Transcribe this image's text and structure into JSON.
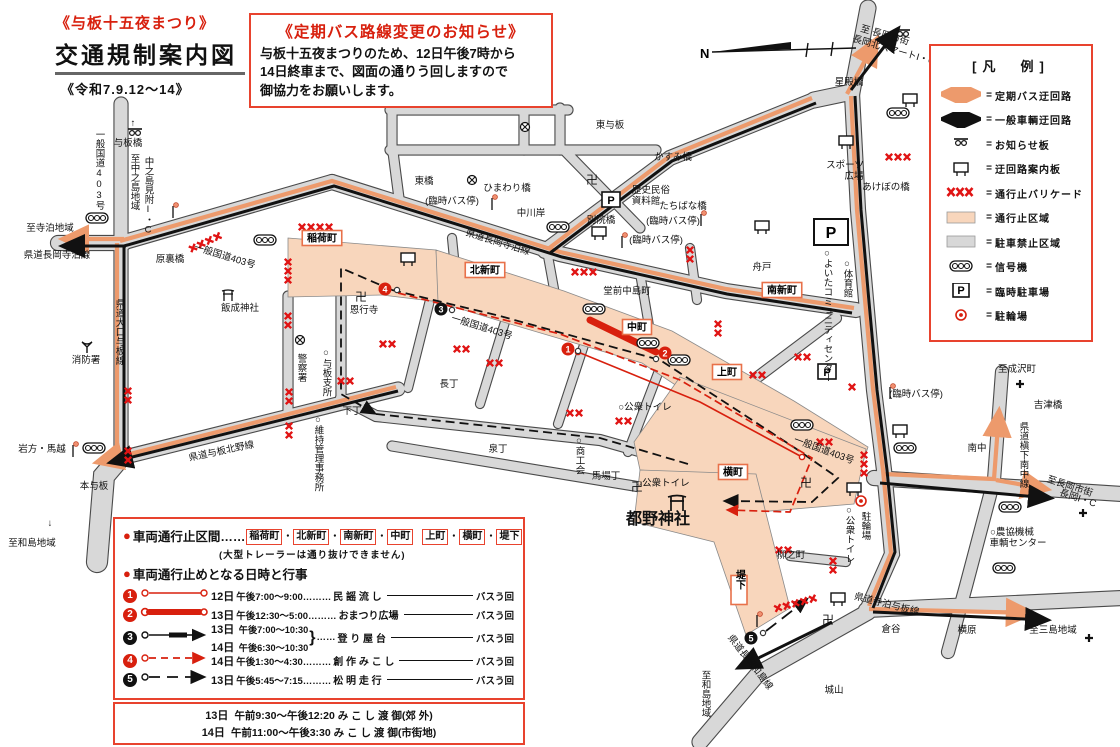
{
  "header": {
    "festival": "《与板十五夜まつり》",
    "title": "交通規制案内図",
    "period": "《令和7.9.12〜14》"
  },
  "notice": {
    "title": "《定期バス路線変更のお知らせ》",
    "lines": [
      "与板十五夜まつりのため、12日午後7時から",
      "14日終車まで、図面の通りう回しますので",
      "御協力をお願いします。"
    ]
  },
  "legend": {
    "title": "[凡　例]",
    "rows": [
      {
        "icon": "bus-detour-arrow",
        "label": "定期バス迂回路"
      },
      {
        "icon": "car-detour-arrow",
        "label": "一般車輌迂回路"
      },
      {
        "icon": "notice-board",
        "label": "お知らせ板"
      },
      {
        "icon": "guide-board",
        "label": "迂回路案内板"
      },
      {
        "icon": "barricade",
        "label": "通行止バリケード"
      },
      {
        "icon": "closed-area",
        "label": "通行止区域"
      },
      {
        "icon": "no-parking-area",
        "label": "駐車禁止区域"
      },
      {
        "icon": "signal",
        "label": "信号機"
      },
      {
        "icon": "parking",
        "label": "臨時駐車場"
      },
      {
        "icon": "bicycle",
        "label": "駐輪場"
      }
    ]
  },
  "restriction": {
    "bullet": "●",
    "sections_label": "車両通行止区間……",
    "towns": [
      "稲荷町",
      "北新町",
      "南新町",
      "中町",
      "上町",
      "横町",
      "堤下"
    ],
    "note": "(大型トレーラーは通り抜けできません)",
    "schedule_label": "車両通行止めとなる日時と行事",
    "rows": [
      {
        "num": "1",
        "color": "#d8200e",
        "style": "thin-red",
        "date": "12日",
        "time": "午後7:00〜9:00………",
        "event": "民 謡 流 し",
        "tail": "バスう回"
      },
      {
        "num": "2",
        "color": "#d8200e",
        "style": "thick-red",
        "date": "13日",
        "time": "午後12:30〜5:00………",
        "event": "おまつり広場",
        "tail": "バスう回"
      },
      {
        "num": "3",
        "color": "#111111",
        "style": "black-dash",
        "dates": [
          "13日",
          "14日"
        ],
        "times": [
          "午後7:00〜10:30",
          "午後6:30〜10:30"
        ],
        "brace": "}",
        "mid": "……",
        "event": "登 り 屋 台",
        "tail": "バスう回"
      },
      {
        "num": "4",
        "color": "#d8200e",
        "style": "red-dash",
        "date": "14日",
        "time": "午後1:30〜4:30………",
        "event": "創 作 み こ し",
        "tail": "バスう回"
      },
      {
        "num": "5",
        "color": "#111111",
        "style": "black-longdash",
        "date": "13日",
        "time": "午後5:45〜7:15………",
        "event": "松 明 走 行",
        "tail": "バスう回"
      }
    ],
    "mikoshi": [
      {
        "date": "13日",
        "text": "午前9:30〜午後12:20 み こ し 渡 御(郊 外)"
      },
      {
        "date": "14日",
        "text": "午前11:00〜午後3:30 み こ し 渡 御(市街地)"
      }
    ]
  },
  "map": {
    "compass_label": "N",
    "labels": [
      {
        "t": "与板橋",
        "x": 128,
        "y": 146
      },
      {
        "t": "一般国道403号",
        "x": 99,
        "y": 170,
        "v": 1
      },
      {
        "t": "↑",
        "x": 133,
        "y": 126
      },
      {
        "t": "至中之島地域",
        "x": 134,
        "y": 182,
        "v": 1
      },
      {
        "t": "中之島見附I・C",
        "x": 148,
        "y": 196,
        "v": 1
      },
      {
        "t": "至寺泊地域",
        "x": 50,
        "y": 231
      },
      {
        "t": "県道長岡寺泊線",
        "x": 57,
        "y": 258
      },
      {
        "t": "県道大口与板線",
        "x": 119,
        "y": 332,
        "v": 1
      },
      {
        "t": "消防署",
        "x": 86,
        "y": 363
      },
      {
        "t": "岩方・馬越",
        "x": 42,
        "y": 452
      },
      {
        "t": "本与板",
        "x": 94,
        "y": 489
      },
      {
        "t": "↓",
        "x": 50,
        "y": 526
      },
      {
        "t": "至和島地域",
        "x": 32,
        "y": 546
      },
      {
        "t": "原裏橋",
        "x": 170,
        "y": 262
      },
      {
        "t": "一般国道403号",
        "x": 224,
        "y": 259,
        "r": 17
      },
      {
        "t": "飯成神社",
        "x": 240,
        "y": 311
      },
      {
        "t": "東与板",
        "x": 610,
        "y": 128
      },
      {
        "t": "東橋",
        "x": 424,
        "y": 184
      },
      {
        "t": "ひまわり橋",
        "x": 507,
        "y": 191
      },
      {
        "t": "(臨時バス停)",
        "x": 452,
        "y": 204
      },
      {
        "t": "中川岸",
        "x": 531,
        "y": 216
      },
      {
        "t": "歴史民俗",
        "x": 651,
        "y": 193
      },
      {
        "t": "資料館",
        "x": 646,
        "y": 204
      },
      {
        "t": "別院橋",
        "x": 601,
        "y": 223
      },
      {
        "t": "たちばな橋",
        "x": 683,
        "y": 209
      },
      {
        "t": "(臨時バス停)",
        "x": 673,
        "y": 224
      },
      {
        "t": "(臨時バス停)",
        "x": 656,
        "y": 243
      },
      {
        "t": "かすみ橋",
        "x": 673,
        "y": 160
      },
      {
        "t": "スポーツ",
        "x": 845,
        "y": 168
      },
      {
        "t": "広場",
        "x": 854,
        "y": 179
      },
      {
        "t": "あけぼの橋",
        "x": 886,
        "y": 190
      },
      {
        "t": "星殿橋",
        "x": 849,
        "y": 85
      },
      {
        "t": "至 長岡市街",
        "x": 884,
        "y": 38,
        "r": 16
      },
      {
        "t": "長岡北スマートI・C",
        "x": 893,
        "y": 53,
        "r": 16
      },
      {
        "t": "舟戸",
        "x": 762,
        "y": 270
      },
      {
        "t": "○体育館",
        "x": 847,
        "y": 278,
        "v": 1
      },
      {
        "t": "○よいたコミュニティセンター",
        "x": 827,
        "y": 315,
        "v": 1
      },
      {
        "t": "堂前中島町",
        "x": 627,
        "y": 294
      },
      {
        "t": "県道長岡寺泊線",
        "x": 497,
        "y": 245,
        "r": 17
      },
      {
        "t": "一般国道403号",
        "x": 481,
        "y": 330,
        "r": 17
      },
      {
        "t": "恩行寺",
        "x": 364,
        "y": 313
      },
      {
        "t": "警察署",
        "x": 301,
        "y": 368,
        "v": 1
      },
      {
        "t": "○与板支所",
        "x": 326,
        "y": 372,
        "v": 1
      },
      {
        "t": "○維持管理事務所",
        "x": 318,
        "y": 453,
        "v": 1
      },
      {
        "t": "下丁",
        "x": 352,
        "y": 414
      },
      {
        "t": "長丁",
        "x": 449,
        "y": 387
      },
      {
        "t": "泉丁",
        "x": 498,
        "y": 452
      },
      {
        "t": "○商工会",
        "x": 579,
        "y": 455,
        "v": 1
      },
      {
        "t": "馬場丁",
        "x": 606,
        "y": 479
      },
      {
        "t": "○公衆トイレ",
        "x": 645,
        "y": 410
      },
      {
        "t": "○公衆トイレ",
        "x": 663,
        "y": 486
      },
      {
        "t": "都野神社",
        "x": 658,
        "y": 524,
        "s": 16,
        "b": 1
      },
      {
        "t": "柳之町",
        "x": 791,
        "y": 558
      },
      {
        "t": "駐輪場",
        "x": 865,
        "y": 526,
        "v": 1
      },
      {
        "t": "○公衆トイレ",
        "x": 849,
        "y": 534,
        "v": 1
      },
      {
        "t": "一般国道403号",
        "x": 823,
        "y": 453,
        "r": 20
      },
      {
        "t": "至成沢町",
        "x": 1017,
        "y": 372
      },
      {
        "t": "吉津橋",
        "x": 1048,
        "y": 408
      },
      {
        "t": "県道槇下南中線",
        "x": 1023,
        "y": 455,
        "v": 1
      },
      {
        "t": "南中",
        "x": 977,
        "y": 451
      },
      {
        "t": "(臨時バス停)",
        "x": 916,
        "y": 397
      },
      {
        "t": "至長岡市街",
        "x": 1069,
        "y": 489,
        "r": 18
      },
      {
        "t": "長岡I・C",
        "x": 1077,
        "y": 501,
        "r": 18
      },
      {
        "t": "○農協機械",
        "x": 1012,
        "y": 535
      },
      {
        "t": "車輌センター",
        "x": 1018,
        "y": 546
      },
      {
        "t": "至三島地域",
        "x": 1053,
        "y": 633
      },
      {
        "t": "横原",
        "x": 967,
        "y": 633
      },
      {
        "t": "倉谷",
        "x": 891,
        "y": 632
      },
      {
        "t": "県道寺泊与板線",
        "x": 886,
        "y": 607,
        "r": 14
      },
      {
        "t": "城山",
        "x": 834,
        "y": 693
      },
      {
        "t": "至和島地域",
        "x": 705,
        "y": 694,
        "v": 1
      },
      {
        "t": "県道長岡和島線",
        "x": 748,
        "y": 664,
        "r": 52
      },
      {
        "t": "県道与板北野線",
        "x": 222,
        "y": 454,
        "r": -12
      },
      {
        "t": "卍",
        "x": 592,
        "y": 184,
        "s": 12
      },
      {
        "t": "卍",
        "x": 361,
        "y": 301,
        "s": 12
      },
      {
        "t": "卍",
        "x": 637,
        "y": 491,
        "s": 12
      },
      {
        "t": "卍",
        "x": 806,
        "y": 487,
        "s": 12
      },
      {
        "t": "卍",
        "x": 828,
        "y": 624,
        "s": 12
      }
    ],
    "chips": [
      {
        "t": "稲荷町",
        "x": 322,
        "y": 238
      },
      {
        "t": "北新町",
        "x": 485,
        "y": 270
      },
      {
        "t": "南新町",
        "x": 782,
        "y": 290
      },
      {
        "t": "中町",
        "x": 637,
        "y": 327
      },
      {
        "t": "上町",
        "x": 727,
        "y": 372
      },
      {
        "t": "横町",
        "x": 733,
        "y": 472
      },
      {
        "t": "堤下",
        "x": 739,
        "y": 590,
        "v": 1
      }
    ],
    "markers": [
      {
        "n": "1",
        "c": "#d8200e",
        "x": 568,
        "y": 349
      },
      {
        "n": "2",
        "c": "#d8200e",
        "x": 665,
        "y": 353
      },
      {
        "n": "3",
        "c": "#111111",
        "x": 441,
        "y": 309
      },
      {
        "n": "4",
        "c": "#d8200e",
        "x": 385,
        "y": 289
      },
      {
        "n": "5",
        "c": "#111111",
        "x": 751,
        "y": 638
      }
    ],
    "icons": [
      {
        "k": "signal",
        "x": 97,
        "y": 218
      },
      {
        "k": "signal",
        "x": 265,
        "y": 240
      },
      {
        "k": "signal",
        "x": 558,
        "y": 227
      },
      {
        "k": "signal",
        "x": 594,
        "y": 309
      },
      {
        "k": "signal",
        "x": 648,
        "y": 343
      },
      {
        "k": "signal",
        "x": 679,
        "y": 360
      },
      {
        "k": "signal",
        "x": 802,
        "y": 425
      },
      {
        "k": "signal",
        "x": 905,
        "y": 448
      },
      {
        "k": "signal",
        "x": 1010,
        "y": 507
      },
      {
        "k": "signal",
        "x": 898,
        "y": 113
      },
      {
        "k": "signal",
        "x": 94,
        "y": 448
      },
      {
        "k": "signal",
        "x": 1004,
        "y": 568
      },
      {
        "k": "board",
        "x": 135,
        "y": 132
      },
      {
        "k": "board",
        "x": 903,
        "y": 33
      },
      {
        "k": "gboard",
        "x": 408,
        "y": 259
      },
      {
        "k": "gboard",
        "x": 599,
        "y": 233
      },
      {
        "k": "gboard",
        "x": 762,
        "y": 227
      },
      {
        "k": "gboard",
        "x": 910,
        "y": 100
      },
      {
        "k": "gboard",
        "x": 846,
        "y": 142
      },
      {
        "k": "gboard",
        "x": 900,
        "y": 431
      },
      {
        "k": "gboard",
        "x": 854,
        "y": 489
      },
      {
        "k": "gboard",
        "x": 838,
        "y": 599
      },
      {
        "k": "pole",
        "x": 173,
        "y": 210
      },
      {
        "k": "pole",
        "x": 73,
        "y": 449
      },
      {
        "k": "pole",
        "x": 492,
        "y": 202
      },
      {
        "k": "pole",
        "x": 701,
        "y": 218
      },
      {
        "k": "pole",
        "x": 622,
        "y": 240
      },
      {
        "k": "pole",
        "x": 890,
        "y": 391
      },
      {
        "k": "pole",
        "x": 757,
        "y": 619
      },
      {
        "k": "parkS",
        "x": 611,
        "y": 200
      },
      {
        "k": "parkS",
        "x": 827,
        "y": 372
      },
      {
        "k": "parkB",
        "x": 831,
        "y": 232
      },
      {
        "k": "bike",
        "x": 861,
        "y": 501
      },
      {
        "k": "torii",
        "x": 228,
        "y": 296
      },
      {
        "k": "toriiB",
        "x": 677,
        "y": 504
      },
      {
        "k": "cross",
        "x": 300,
        "y": 340
      },
      {
        "k": "cross",
        "x": 472,
        "y": 180
      },
      {
        "k": "cross",
        "x": 525,
        "y": 127
      },
      {
        "k": "fire",
        "x": 87,
        "y": 347
      },
      {
        "k": "dirx",
        "x": 1020,
        "y": 384
      },
      {
        "k": "dirx",
        "x": 1083,
        "y": 513
      },
      {
        "k": "dirx",
        "x": 1089,
        "y": 638
      },
      {
        "k": "dot",
        "x": 578,
        "y": 351
      },
      {
        "k": "dot",
        "x": 656,
        "y": 359
      },
      {
        "k": "dot",
        "x": 452,
        "y": 310
      },
      {
        "k": "dot",
        "x": 397,
        "y": 290
      },
      {
        "k": "dot",
        "x": 763,
        "y": 633
      }
    ],
    "barricades": [
      {
        "x": 302,
        "y": 227,
        "n": 4,
        "a": 0
      },
      {
        "x": 193,
        "y": 248,
        "n": 4,
        "a": -25
      },
      {
        "x": 288,
        "y": 262,
        "n": 3,
        "a": 90
      },
      {
        "x": 288,
        "y": 316,
        "n": 2,
        "a": 90
      },
      {
        "x": 289,
        "y": 392,
        "n": 2,
        "a": 90
      },
      {
        "x": 289,
        "y": 426,
        "n": 2,
        "a": 90
      },
      {
        "x": 341,
        "y": 381,
        "n": 2,
        "a": 0
      },
      {
        "x": 383,
        "y": 344,
        "n": 2,
        "a": 0
      },
      {
        "x": 457,
        "y": 349,
        "n": 2,
        "a": 0
      },
      {
        "x": 490,
        "y": 363,
        "n": 2,
        "a": 0
      },
      {
        "x": 570,
        "y": 413,
        "n": 2,
        "a": 0
      },
      {
        "x": 619,
        "y": 421,
        "n": 2,
        "a": 0
      },
      {
        "x": 575,
        "y": 272,
        "n": 3,
        "a": 0
      },
      {
        "x": 718,
        "y": 324,
        "n": 2,
        "a": 90
      },
      {
        "x": 753,
        "y": 375,
        "n": 2,
        "a": 0
      },
      {
        "x": 798,
        "y": 357,
        "n": 2,
        "a": 0
      },
      {
        "x": 852,
        "y": 387,
        "n": 1,
        "a": 0
      },
      {
        "x": 864,
        "y": 455,
        "n": 3,
        "a": 90
      },
      {
        "x": 820,
        "y": 442,
        "n": 2,
        "a": 0
      },
      {
        "x": 690,
        "y": 250,
        "n": 2,
        "a": 90
      },
      {
        "x": 889,
        "y": 157,
        "n": 3,
        "a": 0
      },
      {
        "x": 833,
        "y": 561,
        "n": 2,
        "a": 90
      },
      {
        "x": 779,
        "y": 550,
        "n": 2,
        "a": 0
      },
      {
        "x": 778,
        "y": 608,
        "n": 5,
        "a": -15
      },
      {
        "x": 128,
        "y": 391,
        "n": 2,
        "a": 90
      },
      {
        "x": 128,
        "y": 451,
        "n": 2,
        "a": 90
      }
    ]
  }
}
